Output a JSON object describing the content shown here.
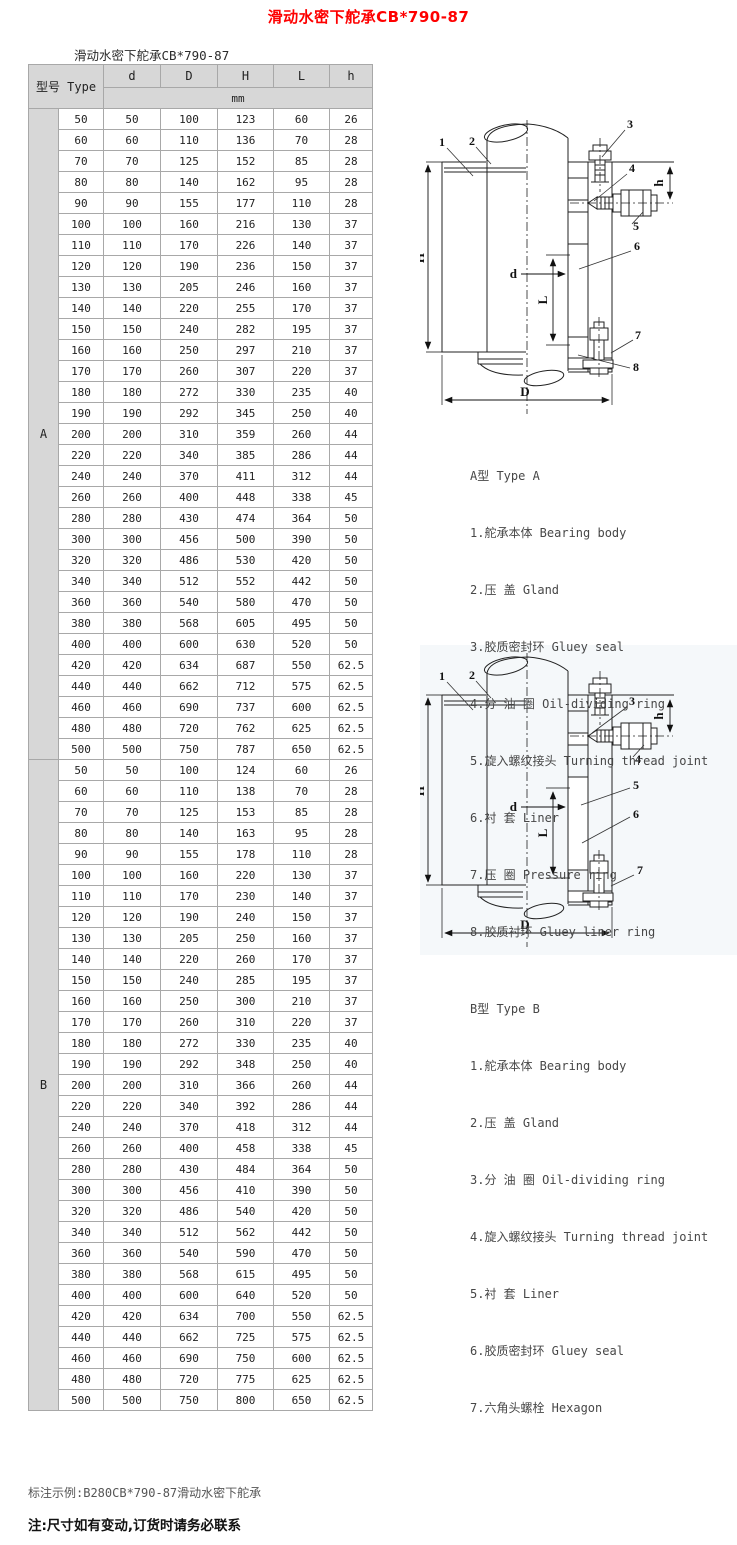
{
  "page": {
    "title": "滑动水密下舵承CB*790-87",
    "subtitle": "滑动水密下舵承CB*790-87",
    "title_color": "#fe0000",
    "header_bg": "#d7d7d7",
    "note_example": "标注示例:B280CB*790-87滑动水密下舵承",
    "note_warning": "注:尺寸如有变动,订货时请务必联系"
  },
  "table": {
    "header": {
      "model_label": "型号 Type",
      "columns": [
        "d",
        "D",
        "H",
        "L",
        "h"
      ],
      "unit": "mm"
    },
    "sections": [
      {
        "label": "A",
        "rows": [
          [
            "50",
            "50",
            "100",
            "123",
            "60",
            "26"
          ],
          [
            "60",
            "60",
            "110",
            "136",
            "70",
            "28"
          ],
          [
            "70",
            "70",
            "125",
            "152",
            "85",
            "28"
          ],
          [
            "80",
            "80",
            "140",
            "162",
            "95",
            "28"
          ],
          [
            "90",
            "90",
            "155",
            "177",
            "110",
            "28"
          ],
          [
            "100",
            "100",
            "160",
            "216",
            "130",
            "37"
          ],
          [
            "110",
            "110",
            "170",
            "226",
            "140",
            "37"
          ],
          [
            "120",
            "120",
            "190",
            "236",
            "150",
            "37"
          ],
          [
            "130",
            "130",
            "205",
            "246",
            "160",
            "37"
          ],
          [
            "140",
            "140",
            "220",
            "255",
            "170",
            "37"
          ],
          [
            "150",
            "150",
            "240",
            "282",
            "195",
            "37"
          ],
          [
            "160",
            "160",
            "250",
            "297",
            "210",
            "37"
          ],
          [
            "170",
            "170",
            "260",
            "307",
            "220",
            "37"
          ],
          [
            "180",
            "180",
            "272",
            "330",
            "235",
            "40"
          ],
          [
            "190",
            "190",
            "292",
            "345",
            "250",
            "40"
          ],
          [
            "200",
            "200",
            "310",
            "359",
            "260",
            "44"
          ],
          [
            "220",
            "220",
            "340",
            "385",
            "286",
            "44"
          ],
          [
            "240",
            "240",
            "370",
            "411",
            "312",
            "44"
          ],
          [
            "260",
            "260",
            "400",
            "448",
            "338",
            "45"
          ],
          [
            "280",
            "280",
            "430",
            "474",
            "364",
            "50"
          ],
          [
            "300",
            "300",
            "456",
            "500",
            "390",
            "50"
          ],
          [
            "320",
            "320",
            "486",
            "530",
            "420",
            "50"
          ],
          [
            "340",
            "340",
            "512",
            "552",
            "442",
            "50"
          ],
          [
            "360",
            "360",
            "540",
            "580",
            "470",
            "50"
          ],
          [
            "380",
            "380",
            "568",
            "605",
            "495",
            "50"
          ],
          [
            "400",
            "400",
            "600",
            "630",
            "520",
            "50"
          ],
          [
            "420",
            "420",
            "634",
            "687",
            "550",
            "62.5"
          ],
          [
            "440",
            "440",
            "662",
            "712",
            "575",
            "62.5"
          ],
          [
            "460",
            "460",
            "690",
            "737",
            "600",
            "62.5"
          ],
          [
            "480",
            "480",
            "720",
            "762",
            "625",
            "62.5"
          ],
          [
            "500",
            "500",
            "750",
            "787",
            "650",
            "62.5"
          ]
        ]
      },
      {
        "label": "B",
        "rows": [
          [
            "50",
            "50",
            "100",
            "124",
            "60",
            "26"
          ],
          [
            "60",
            "60",
            "110",
            "138",
            "70",
            "28"
          ],
          [
            "70",
            "70",
            "125",
            "153",
            "85",
            "28"
          ],
          [
            "80",
            "80",
            "140",
            "163",
            "95",
            "28"
          ],
          [
            "90",
            "90",
            "155",
            "178",
            "110",
            "28"
          ],
          [
            "100",
            "100",
            "160",
            "220",
            "130",
            "37"
          ],
          [
            "110",
            "110",
            "170",
            "230",
            "140",
            "37"
          ],
          [
            "120",
            "120",
            "190",
            "240",
            "150",
            "37"
          ],
          [
            "130",
            "130",
            "205",
            "250",
            "160",
            "37"
          ],
          [
            "140",
            "140",
            "220",
            "260",
            "170",
            "37"
          ],
          [
            "150",
            "150",
            "240",
            "285",
            "195",
            "37"
          ],
          [
            "160",
            "160",
            "250",
            "300",
            "210",
            "37"
          ],
          [
            "170",
            "170",
            "260",
            "310",
            "220",
            "37"
          ],
          [
            "180",
            "180",
            "272",
            "330",
            "235",
            "40"
          ],
          [
            "190",
            "190",
            "292",
            "348",
            "250",
            "40"
          ],
          [
            "200",
            "200",
            "310",
            "366",
            "260",
            "44"
          ],
          [
            "220",
            "220",
            "340",
            "392",
            "286",
            "44"
          ],
          [
            "240",
            "240",
            "370",
            "418",
            "312",
            "44"
          ],
          [
            "260",
            "260",
            "400",
            "458",
            "338",
            "45"
          ],
          [
            "280",
            "280",
            "430",
            "484",
            "364",
            "50"
          ],
          [
            "300",
            "300",
            "456",
            "410",
            "390",
            "50"
          ],
          [
            "320",
            "320",
            "486",
            "540",
            "420",
            "50"
          ],
          [
            "340",
            "340",
            "512",
            "562",
            "442",
            "50"
          ],
          [
            "360",
            "360",
            "540",
            "590",
            "470",
            "50"
          ],
          [
            "380",
            "380",
            "568",
            "615",
            "495",
            "50"
          ],
          [
            "400",
            "400",
            "600",
            "640",
            "520",
            "50"
          ],
          [
            "420",
            "420",
            "634",
            "700",
            "550",
            "62.5"
          ],
          [
            "440",
            "440",
            "662",
            "725",
            "575",
            "62.5"
          ],
          [
            "460",
            "460",
            "690",
            "750",
            "600",
            "62.5"
          ],
          [
            "480",
            "480",
            "720",
            "775",
            "625",
            "62.5"
          ],
          [
            "500",
            "500",
            "750",
            "800",
            "650",
            "62.5"
          ]
        ]
      }
    ]
  },
  "diagrams": {
    "dim_labels": {
      "H": "H",
      "D": "D",
      "d": "d",
      "L": "L",
      "h": "h"
    },
    "a": {
      "callouts": [
        "1",
        "2",
        "3",
        "4",
        "5",
        "6",
        "7",
        "8"
      ]
    },
    "b": {
      "callouts": [
        "1",
        "2",
        "3",
        "4",
        "5",
        "6",
        "7"
      ]
    }
  },
  "legends": {
    "a": {
      "title": "A型 Type A",
      "items": [
        "1.舵承本体 Bearing body",
        "2.压 盖 Gland",
        "3.胶质密封环 Gluey seal",
        "4.分 油 圈 Oil-dividing ring",
        "5.旋入螺纹接头 Turning thread joint",
        "6.衬 套 Liner",
        "7.压 圈 Pressure ring",
        "8.胶质衬环 Gluey liner ring"
      ]
    },
    "b": {
      "title": "B型 Type B",
      "items": [
        "1.舵承本体 Bearing body",
        "2.压 盖 Gland",
        "3.分 油 圈 Oil-dividing ring",
        "4.旋入螺纹接头 Turning thread joint",
        "5.衬 套 Liner",
        "6.胶质密封环 Gluey seal",
        "7.六角头螺栓 Hexagon"
      ]
    }
  }
}
